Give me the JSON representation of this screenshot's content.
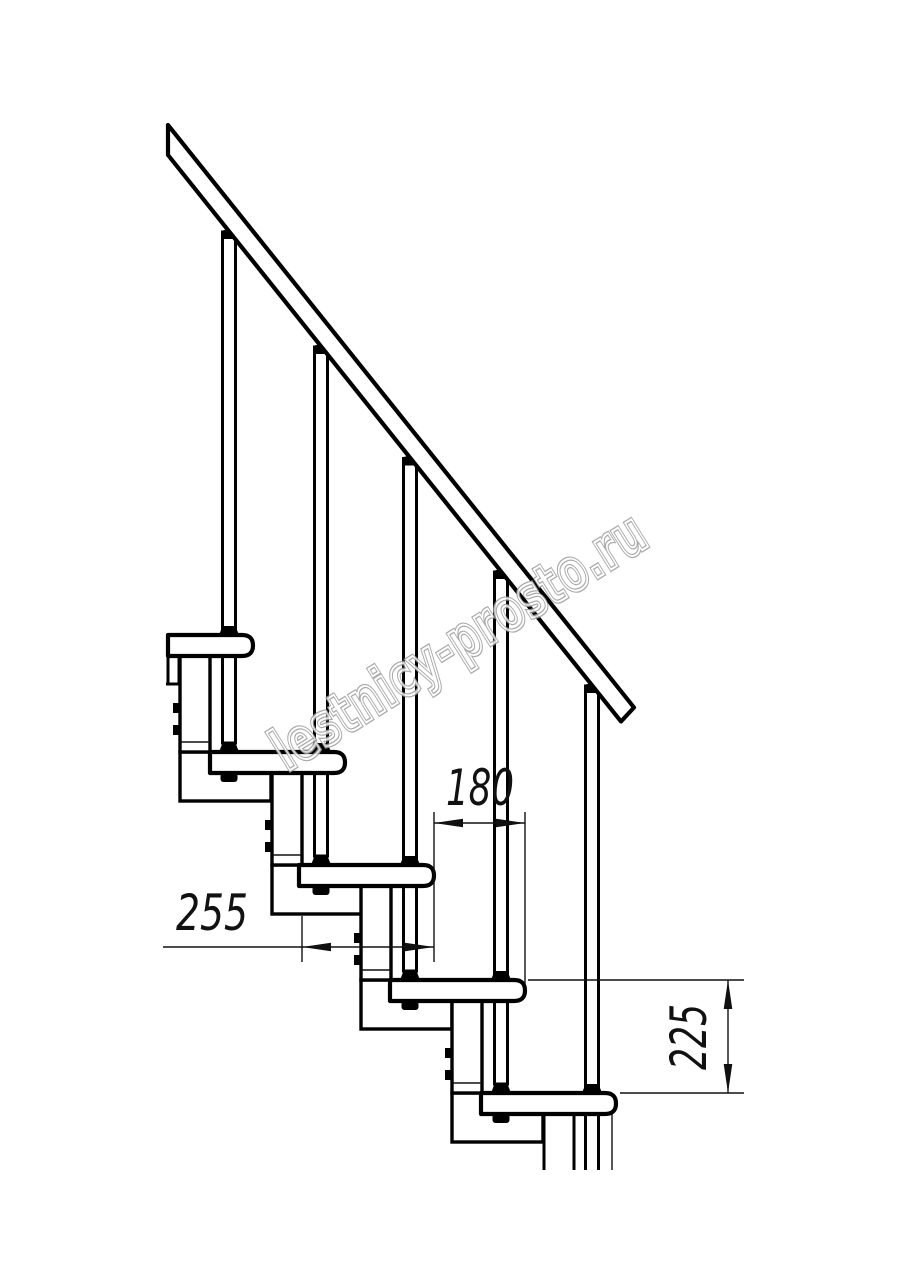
{
  "page": {
    "background_color": "#ffffff"
  },
  "drawing": {
    "description": "Side elevation technical drawing of a modular staircase: sloped handrail, five balusters, five treads with rounded noses, stringer support modules with bolt tabs",
    "line_color": "#000000",
    "treads_visible": 5,
    "balusters_visible": 5,
    "dimensions": {
      "run": {
        "label": "180",
        "orientation": "horizontal"
      },
      "depth": {
        "label": "255",
        "orientation": "horizontal"
      },
      "rise": {
        "label": "225",
        "orientation": "vertical"
      }
    }
  },
  "watermark": {
    "text": "lestnicy-prosto.ru",
    "outline_color": "#9c9c9c",
    "rotation_deg": -32
  }
}
